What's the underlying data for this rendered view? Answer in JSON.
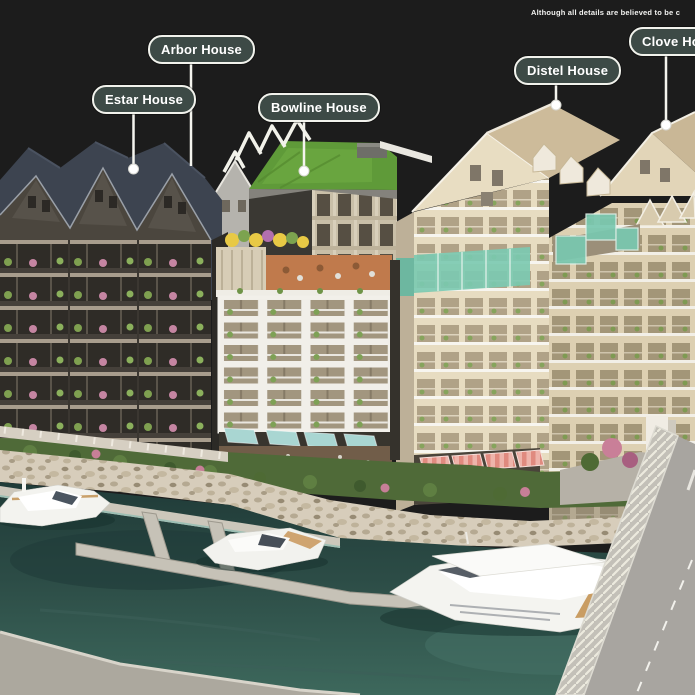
{
  "disclaimer": "Although all details are believed to be c",
  "labels": {
    "estar": "Estar House",
    "arbor": "Arbor House",
    "bowline": "Bowline House",
    "distel": "Distel House",
    "clove": "Clove House"
  },
  "palette": {
    "background": "#1c1c1c",
    "label_fill": "#3d4a46",
    "label_border": "#f1f2ec",
    "label_text": "#ffffff",
    "dark_facade": "#4b463e",
    "dark_roof": "#3d4450",
    "white_building": "#f1efe9",
    "cream_facade": "#e7dcc1",
    "roof_tan": "#cdbb9a",
    "green_roof": "#5f9a39",
    "teal_glass": "#7cc9b1",
    "awning_teal": "#a9d6d2",
    "awning_pink": "#e8a79e",
    "water_deep": "#27443f",
    "water_light": "#3d685c",
    "stone_embankment": "#d7cdbb",
    "pontoon": "#c6c2b7",
    "boat_white": "#f4f4f0",
    "deck_wood": "#c99d63"
  }
}
